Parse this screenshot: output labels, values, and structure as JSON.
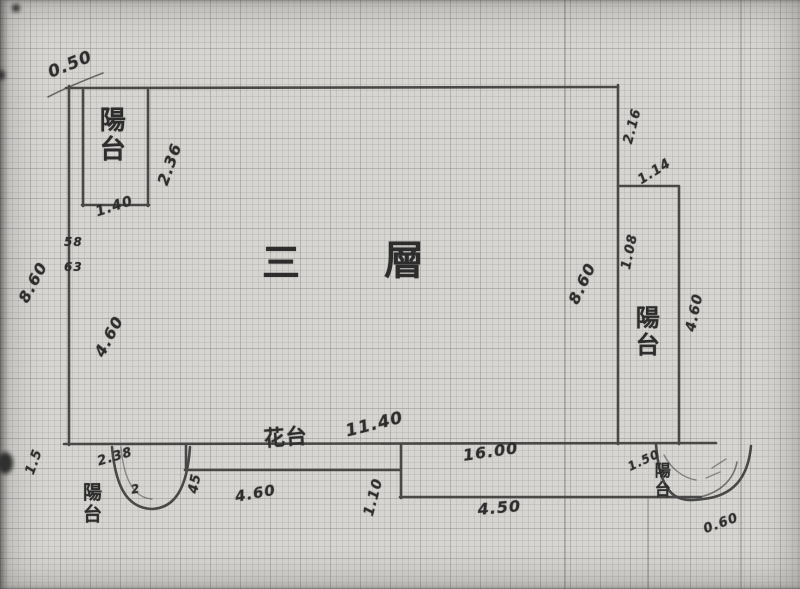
{
  "document": {
    "kind": "hand-drawn third-floor plan sketch on graph paper",
    "floor_label": "三 層"
  },
  "colors": {
    "paper": "#d7d5d1",
    "ink": "#3a3a3a",
    "text": "#2d2d2d"
  },
  "labels": [
    {
      "name": "dim-top-left-offset",
      "text": "0.50",
      "x": 46,
      "y": 66,
      "rot": -22,
      "size": 17
    },
    {
      "name": "balcony-top-left-label",
      "text": "陽台",
      "x": 96,
      "y": 106,
      "size": 26,
      "vertical": true
    },
    {
      "name": "dim-balcony-top-left-width",
      "text": "2.36",
      "x": 155,
      "y": 182,
      "rot": -70,
      "size": 16
    },
    {
      "name": "dim-balcony-top-left-depth",
      "text": "1.40",
      "x": 94,
      "y": 206,
      "rot": -18,
      "size": 14
    },
    {
      "name": "dim-left-height",
      "text": "8.60",
      "x": 16,
      "y": 298,
      "rot": -62,
      "size": 16
    },
    {
      "name": "wall-mark-left-upper",
      "text": "58",
      "x": 64,
      "y": 236,
      "rot": 0,
      "size": 12
    },
    {
      "name": "wall-mark-left-lower",
      "text": "63",
      "x": 64,
      "y": 261,
      "rot": 0,
      "size": 12
    },
    {
      "name": "dim-left-inner",
      "text": "4.60",
      "x": 92,
      "y": 352,
      "rot": -62,
      "size": 16
    },
    {
      "name": "floor-label-first-char",
      "text": "三",
      "x": 262,
      "y": 244,
      "rot": 0,
      "size": 38,
      "cjk": true
    },
    {
      "name": "floor-label-second-char",
      "text": "層",
      "x": 384,
      "y": 240,
      "rot": 0,
      "size": 40,
      "cjk": true
    },
    {
      "name": "dim-bottom-width",
      "text": "11.40",
      "x": 344,
      "y": 424,
      "rot": -14,
      "size": 17
    },
    {
      "name": "flower-bed-label",
      "text": "花台",
      "x": 263,
      "y": 428,
      "rot": -4,
      "size": 21,
      "cjk": true
    },
    {
      "name": "dim-flower-bed-width",
      "text": "4.60",
      "x": 234,
      "y": 490,
      "rot": -10,
      "size": 15
    },
    {
      "name": "dim-flower-bed-step",
      "text": "45",
      "x": 187,
      "y": 492,
      "rot": -78,
      "size": 13
    },
    {
      "name": "dim-step-right",
      "text": "1.10",
      "x": 362,
      "y": 514,
      "rot": -75,
      "size": 14
    },
    {
      "name": "dim-bottom-right-width",
      "text": "16.00",
      "x": 462,
      "y": 448,
      "rot": -8,
      "size": 16
    },
    {
      "name": "dim-bottom-lower-width",
      "text": "4.50",
      "x": 477,
      "y": 502,
      "rot": -5,
      "size": 16
    },
    {
      "name": "dim-right-upper",
      "text": "2.16",
      "x": 622,
      "y": 142,
      "rot": -75,
      "size": 13
    },
    {
      "name": "dim-right-notch",
      "text": "1.14",
      "x": 636,
      "y": 176,
      "rot": -32,
      "size": 13
    },
    {
      "name": "dim-right-balcony-top",
      "text": "1.08",
      "x": 620,
      "y": 268,
      "rot": -78,
      "size": 13
    },
    {
      "name": "dim-right-height",
      "text": "8.60",
      "x": 566,
      "y": 300,
      "rot": -65,
      "size": 16
    },
    {
      "name": "balcony-right-label",
      "text": "陽台",
      "x": 632,
      "y": 305,
      "size": 24,
      "vertical": true
    },
    {
      "name": "dim-right-balcony-height",
      "text": "4.60",
      "x": 684,
      "y": 330,
      "rot": -78,
      "size": 14
    },
    {
      "name": "dim-balcony-bottom-left",
      "text": "2.38",
      "x": 96,
      "y": 456,
      "rot": -16,
      "size": 13
    },
    {
      "name": "mark-balcony-bottom-left",
      "text": "2",
      "x": 130,
      "y": 484,
      "rot": -10,
      "size": 12
    },
    {
      "name": "balcony-bottom-left-label",
      "text": "陽台",
      "x": 80,
      "y": 482,
      "size": 19,
      "vertical": true
    },
    {
      "name": "dim-bottom-left-edge",
      "text": "1.5",
      "x": 24,
      "y": 472,
      "rot": -70,
      "size": 13
    },
    {
      "name": "dim-balcony-bottom-right-a",
      "text": "1.50",
      "x": 626,
      "y": 462,
      "rot": -25,
      "size": 12
    },
    {
      "name": "balcony-bottom-right-label",
      "text": "陽台",
      "x": 652,
      "y": 462,
      "size": 16,
      "vertical": true
    },
    {
      "name": "dim-balcony-bottom-right-b",
      "text": "0.60",
      "x": 702,
      "y": 524,
      "rot": -20,
      "size": 13
    }
  ]
}
